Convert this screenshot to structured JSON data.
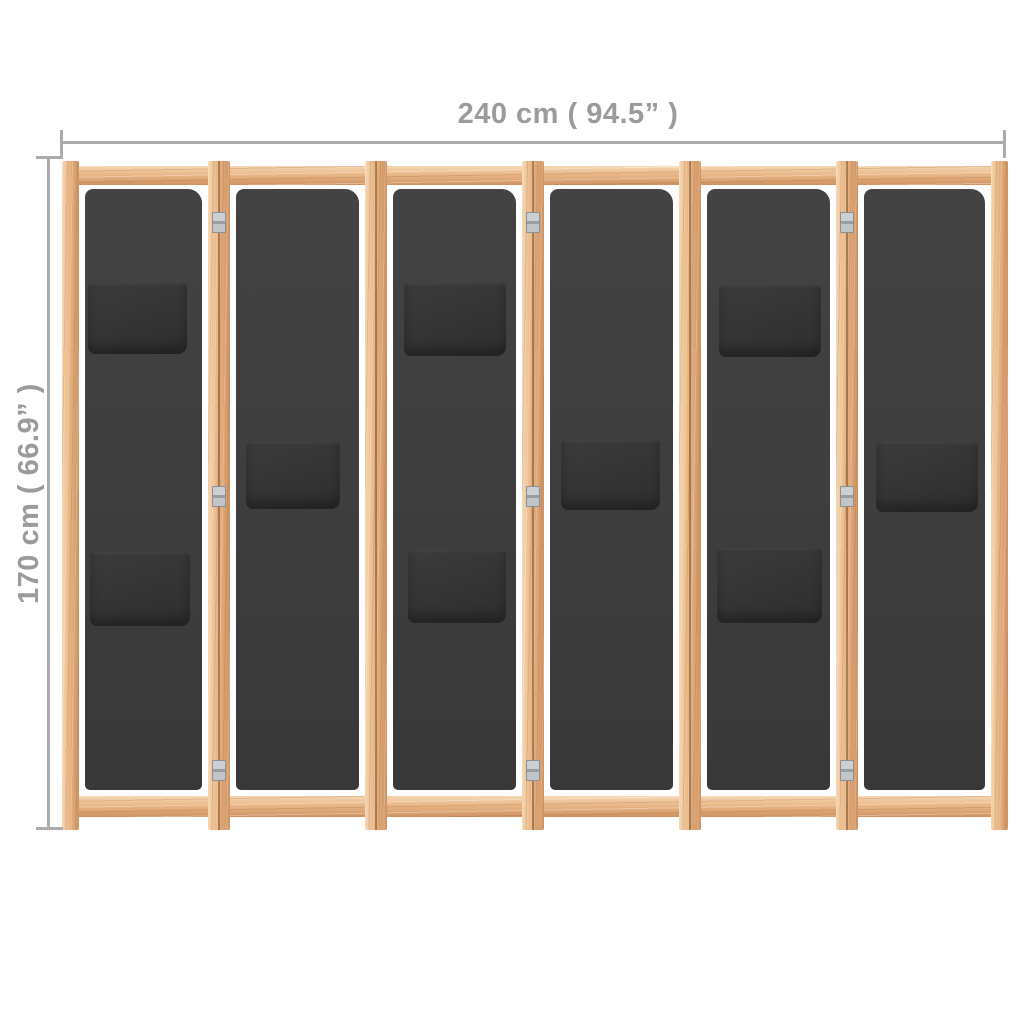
{
  "figure": {
    "subject": "6-panel fabric room divider with wooden frame, front view",
    "background": "#ffffff"
  },
  "dimensions": {
    "width_label": "240 cm ( 94.5” )",
    "height_label": "170 cm ( 66.9” )",
    "text_color": "#9b9b9b",
    "line_color": "#ababab"
  },
  "divider": {
    "colors": {
      "wood_light": "#f6d8b4",
      "wood_mid": "#e9b787",
      "wood_dark": "#cf9261",
      "fabric": "#3f3f3f",
      "fabric_top": "#434343",
      "fabric_bottom": "#383838",
      "pocket": "#343434",
      "hinge_silver": "#c0c3c6"
    },
    "frame": {
      "top_rail": {
        "x": 62,
        "y": 166,
        "w": 946,
        "h": 19
      },
      "bottom_rail": {
        "x": 62,
        "y": 796,
        "w": 946,
        "h": 21
      },
      "posts": [
        {
          "x": 62,
          "y": 161,
          "w": 17,
          "h": 669,
          "double": false
        },
        {
          "x": 208,
          "y": 161,
          "w": 22,
          "h": 669,
          "double": true
        },
        {
          "x": 365,
          "y": 161,
          "w": 22,
          "h": 669,
          "double": true
        },
        {
          "x": 522,
          "y": 161,
          "w": 22,
          "h": 669,
          "double": true
        },
        {
          "x": 679,
          "y": 161,
          "w": 22,
          "h": 669,
          "double": true
        },
        {
          "x": 836,
          "y": 161,
          "w": 22,
          "h": 669,
          "double": true
        },
        {
          "x": 991,
          "y": 161,
          "w": 17,
          "h": 669,
          "double": false
        }
      ]
    },
    "panels": [
      {
        "x": 85,
        "y": 189,
        "w": 117,
        "h": 601,
        "pockets": [
          {
            "x": 88,
            "y": 283,
            "w": 99,
            "h": 71
          },
          {
            "x": 90,
            "y": 552,
            "w": 100,
            "h": 74
          }
        ]
      },
      {
        "x": 236,
        "y": 189,
        "w": 123,
        "h": 601,
        "pockets": [
          {
            "x": 246,
            "y": 442,
            "w": 94,
            "h": 67
          }
        ]
      },
      {
        "x": 393,
        "y": 189,
        "w": 123,
        "h": 601,
        "pockets": [
          {
            "x": 404,
            "y": 283,
            "w": 102,
            "h": 73
          },
          {
            "x": 408,
            "y": 550,
            "w": 98,
            "h": 73
          }
        ]
      },
      {
        "x": 550,
        "y": 189,
        "w": 123,
        "h": 601,
        "pockets": [
          {
            "x": 561,
            "y": 440,
            "w": 99,
            "h": 70
          }
        ]
      },
      {
        "x": 707,
        "y": 189,
        "w": 123,
        "h": 601,
        "pockets": [
          {
            "x": 719,
            "y": 285,
            "w": 102,
            "h": 72
          },
          {
            "x": 717,
            "y": 548,
            "w": 105,
            "h": 75
          }
        ]
      },
      {
        "x": 864,
        "y": 189,
        "w": 121,
        "h": 601,
        "pockets": [
          {
            "x": 876,
            "y": 442,
            "w": 102,
            "h": 70
          }
        ]
      }
    ],
    "hinges": [
      {
        "cx": 219,
        "cy": 222
      },
      {
        "cx": 219,
        "cy": 496
      },
      {
        "cx": 219,
        "cy": 770
      },
      {
        "cx": 533,
        "cy": 222
      },
      {
        "cx": 533,
        "cy": 496
      },
      {
        "cx": 533,
        "cy": 770
      },
      {
        "cx": 847,
        "cy": 222
      },
      {
        "cx": 847,
        "cy": 496
      },
      {
        "cx": 847,
        "cy": 770
      }
    ]
  }
}
